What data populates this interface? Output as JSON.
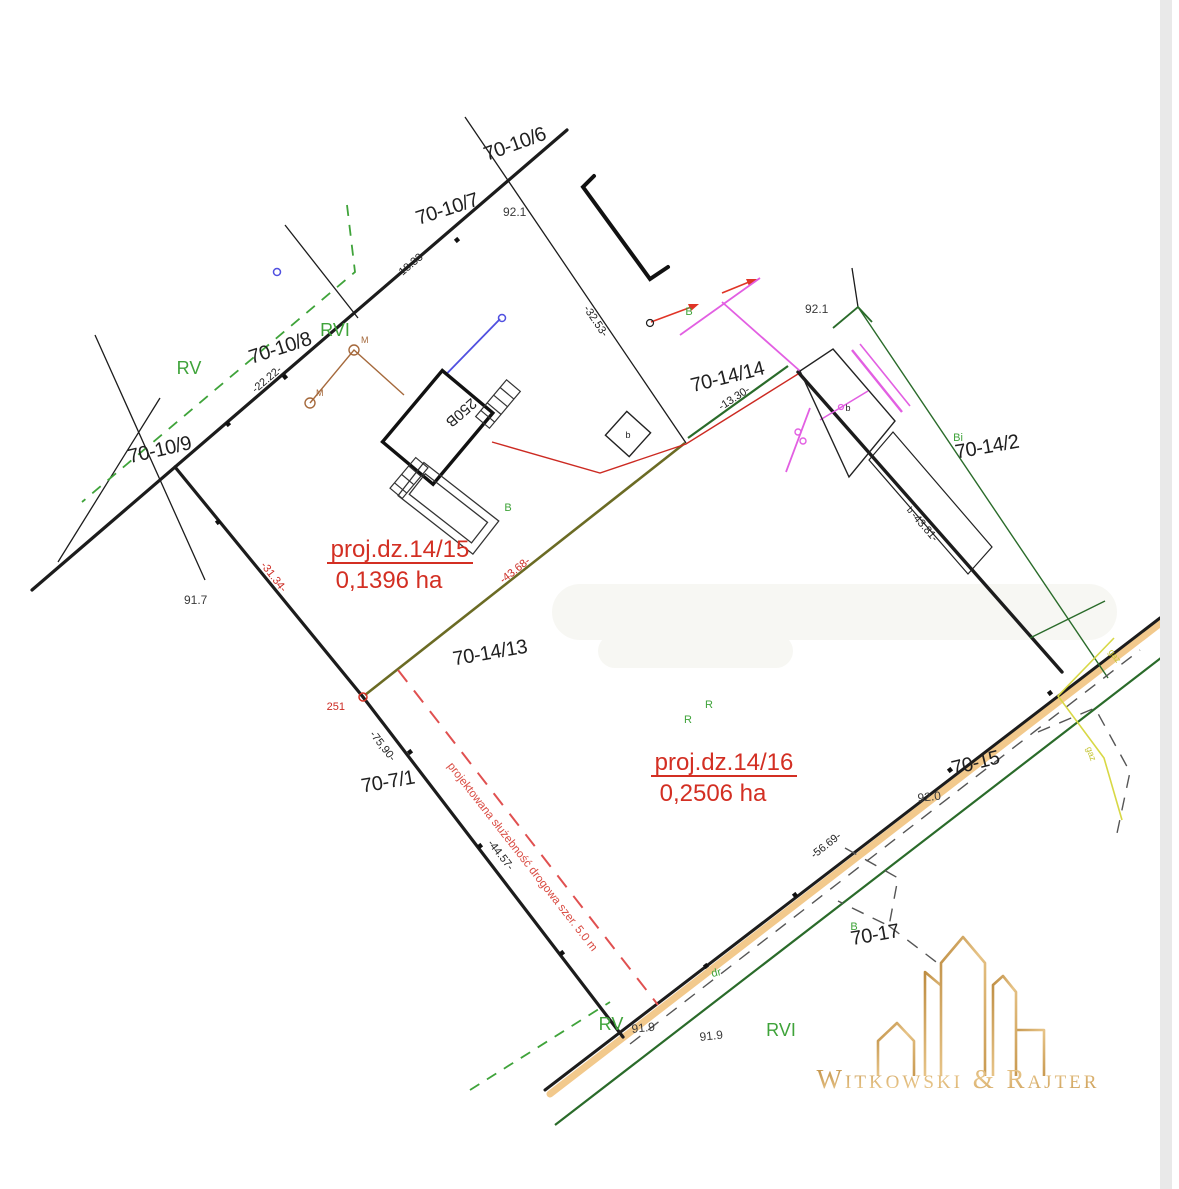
{
  "colors": {
    "boundary_black": "#1c1c1c",
    "accent_red": "#d32f23",
    "land_use_green": "#3fa33a",
    "road_green": "#2a6b2a",
    "utility_magenta": "#e25fe2",
    "utility_brown": "#a5693c",
    "utility_blue": "#5050e0",
    "new_boundary_olive": "#6b6b24",
    "road_tan": "#f2c98c",
    "gas_yellow": "#d8d845",
    "logo_gold": "#cfa258"
  },
  "parcels": [
    {
      "label": "70-10/6"
    },
    {
      "label": "70-10/7"
    },
    {
      "label": "70-10/8"
    },
    {
      "label": "70-10/9"
    },
    {
      "label": "70-14/14"
    },
    {
      "label": "70-14/2"
    },
    {
      "label": "70-14/13"
    },
    {
      "label": "70-7/1"
    },
    {
      "label": "70-15"
    },
    {
      "label": "70-17"
    }
  ],
  "projects": [
    {
      "name": "proj.dz.14/15",
      "area": "0,1396 ha"
    },
    {
      "name": "proj.dz.14/16",
      "area": "0,2506 ha"
    }
  ],
  "measurements": {
    "black": [
      {
        "v": "-18.33-"
      },
      {
        "v": "-22.22-"
      },
      {
        "v": "-32.53-"
      },
      {
        "v": "-13.30-"
      },
      {
        "v": "-43.81-"
      },
      {
        "v": "-75,90-"
      },
      {
        "v": "-44.57-"
      },
      {
        "v": "-56.69-"
      }
    ],
    "red": [
      {
        "v": "-31.34-"
      },
      {
        "v": "-43.68-"
      }
    ],
    "point_number": "251"
  },
  "elevations": [
    {
      "v": "92.1"
    },
    {
      "v": "92.1"
    },
    {
      "v": "91.7"
    },
    {
      "v": "92.0"
    },
    {
      "v": "91.9"
    },
    {
      "v": "91.9"
    }
  ],
  "land_use": [
    {
      "v": "RV"
    },
    {
      "v": "RVI"
    },
    {
      "v": "RV"
    },
    {
      "v": "RVI"
    },
    {
      "v": "B"
    },
    {
      "v": "B"
    },
    {
      "v": "Bi"
    },
    {
      "v": "R"
    },
    {
      "v": "R"
    },
    {
      "v": "B"
    },
    {
      "v": "dr"
    }
  ],
  "buildings": [
    {
      "v": "250B"
    },
    {
      "v": "b"
    },
    {
      "v": "b"
    },
    {
      "v": "b"
    }
  ],
  "utility_marks": [
    {
      "v": "M"
    },
    {
      "v": "M"
    }
  ],
  "gas_labels": [
    {
      "v": "gaz"
    },
    {
      "v": "gaz"
    }
  ],
  "annotations": {
    "servitude": "projektowana służebność drogowa szer. 5.0 m"
  },
  "logo": {
    "text": "Witkowski & Rajter"
  }
}
